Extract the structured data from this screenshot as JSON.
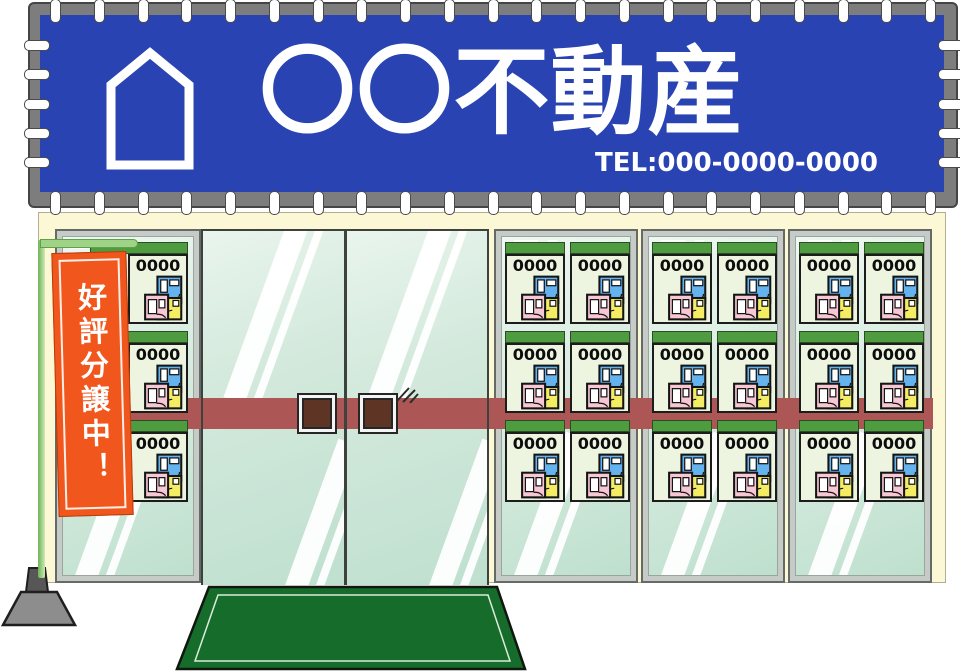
{
  "title_banner": {
    "company_name": "〇〇不動産",
    "tel": "TEL:000-0000-0000",
    "banner_color": "#2944b2",
    "frame_color": "#7d7d7d",
    "house_icon": "house-outline-icon"
  },
  "nobori": {
    "text": "好評分譲中！",
    "banner_color": "#f1571c",
    "pole_color": "#a8da8e",
    "base_color": "#8d8d8d"
  },
  "flyers": {
    "price": "0000",
    "header_color": "#4f9b40",
    "card_color": "#edf5e1",
    "plan_colors": {
      "blue": "#64b2ee",
      "pink": "#f7c7d3",
      "yellow": "#f4ec63"
    },
    "left_rack_count": 3,
    "right_window_sections": 3,
    "flyers_per_section": 6
  },
  "storefront": {
    "facade_color": "#fcf8d6",
    "glass_tint": "#cfe7d9",
    "push_bar_color": "#ad5656",
    "door_handle_color": "#5e3425",
    "entrance_mat_color": "#156c2b"
  }
}
